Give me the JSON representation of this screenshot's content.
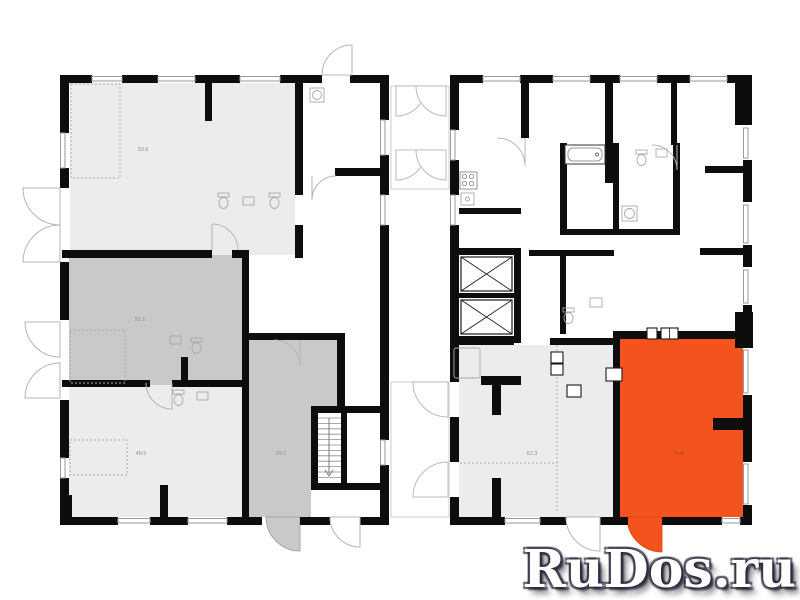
{
  "canvas": {
    "width": 800,
    "height": 600,
    "background": "#ffffff"
  },
  "watermark": {
    "text": "RuDos.ru",
    "color": "#ffffff",
    "shadow_color": "#28283a"
  },
  "colors": {
    "wall": "#0d0d0d",
    "room_light": "#ececec",
    "room_medium": "#c9c9c9",
    "room_highlight": "#f4531d",
    "window_line": "#9a9a9a",
    "door_arc": "#b5b5b5",
    "fixture_line": "#a8a8a8"
  },
  "left_building": {
    "name": "left-section",
    "rooms": [
      {
        "id": "room-top-left",
        "area_label": "93.6",
        "shade": "light"
      },
      {
        "id": "room-middle-left",
        "area_label": "92.1",
        "shade": "medium"
      },
      {
        "id": "room-bottom-left",
        "area_label": "48.9",
        "shade": "light"
      },
      {
        "id": "room-small-gray",
        "area_label": "29.1",
        "shade": "medium"
      }
    ]
  },
  "right_building": {
    "name": "right-section",
    "rooms": [
      {
        "id": "room-gray-right",
        "area_label": "62.3",
        "shade": "light"
      },
      {
        "id": "room-orange",
        "area_label": "75.4",
        "shade": "highlight"
      }
    ]
  }
}
